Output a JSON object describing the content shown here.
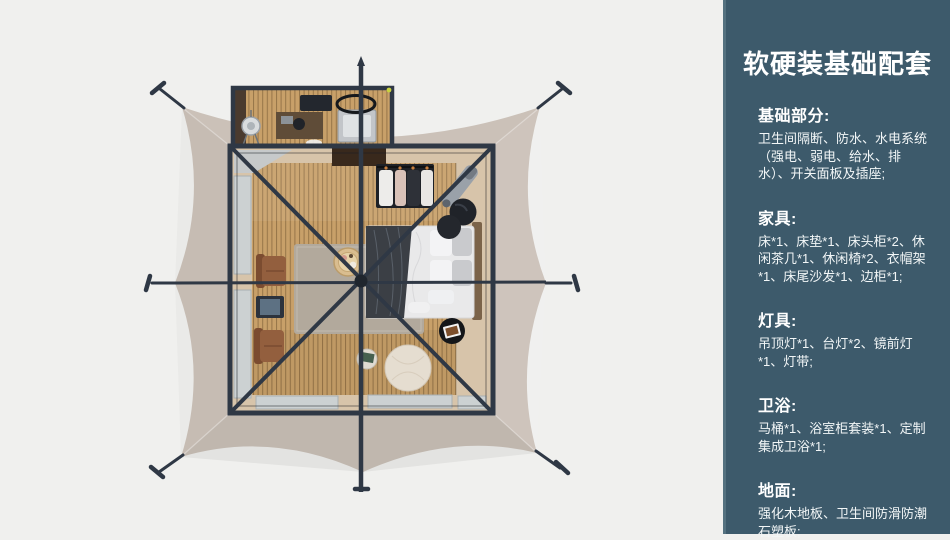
{
  "panel": {
    "title": "软硬装基础配套",
    "sections": [
      {
        "heading": "基础部分:",
        "body": "卫生间隔断、防水、水电系统（强电、弱电、给水、排水）、开关面板及插座;"
      },
      {
        "heading": "家具:",
        "body": "床*1、床垫*1、床头柜*2、休闲茶几*1、休闲椅*2、衣帽架*1、床尾沙发*1、边柜*1;"
      },
      {
        "heading": "灯具:",
        "body": "吊顶灯*1、台灯*2、镜前灯*1、灯带;"
      },
      {
        "heading": "卫浴:",
        "body": "马桶*1、浴室柜套装*1、定制集成卫浴*1;"
      },
      {
        "heading": "地面:",
        "body": "强化木地板、卫生间防滑防潮石塑板;"
      }
    ]
  },
  "palette": {
    "bg": "#f0f0ee",
    "panel-bg": "#3d5a6b",
    "panel-edge": "#54717f",
    "panel-text": "#f2f6f7",
    "frame": "#2f3845",
    "canvas": "#cbc1b8",
    "floor": "#c8a069",
    "wall": "#d7c4aa",
    "window": "#ccd1d2",
    "rug": "#b2a99c",
    "pouf": "#e5ddd0"
  }
}
